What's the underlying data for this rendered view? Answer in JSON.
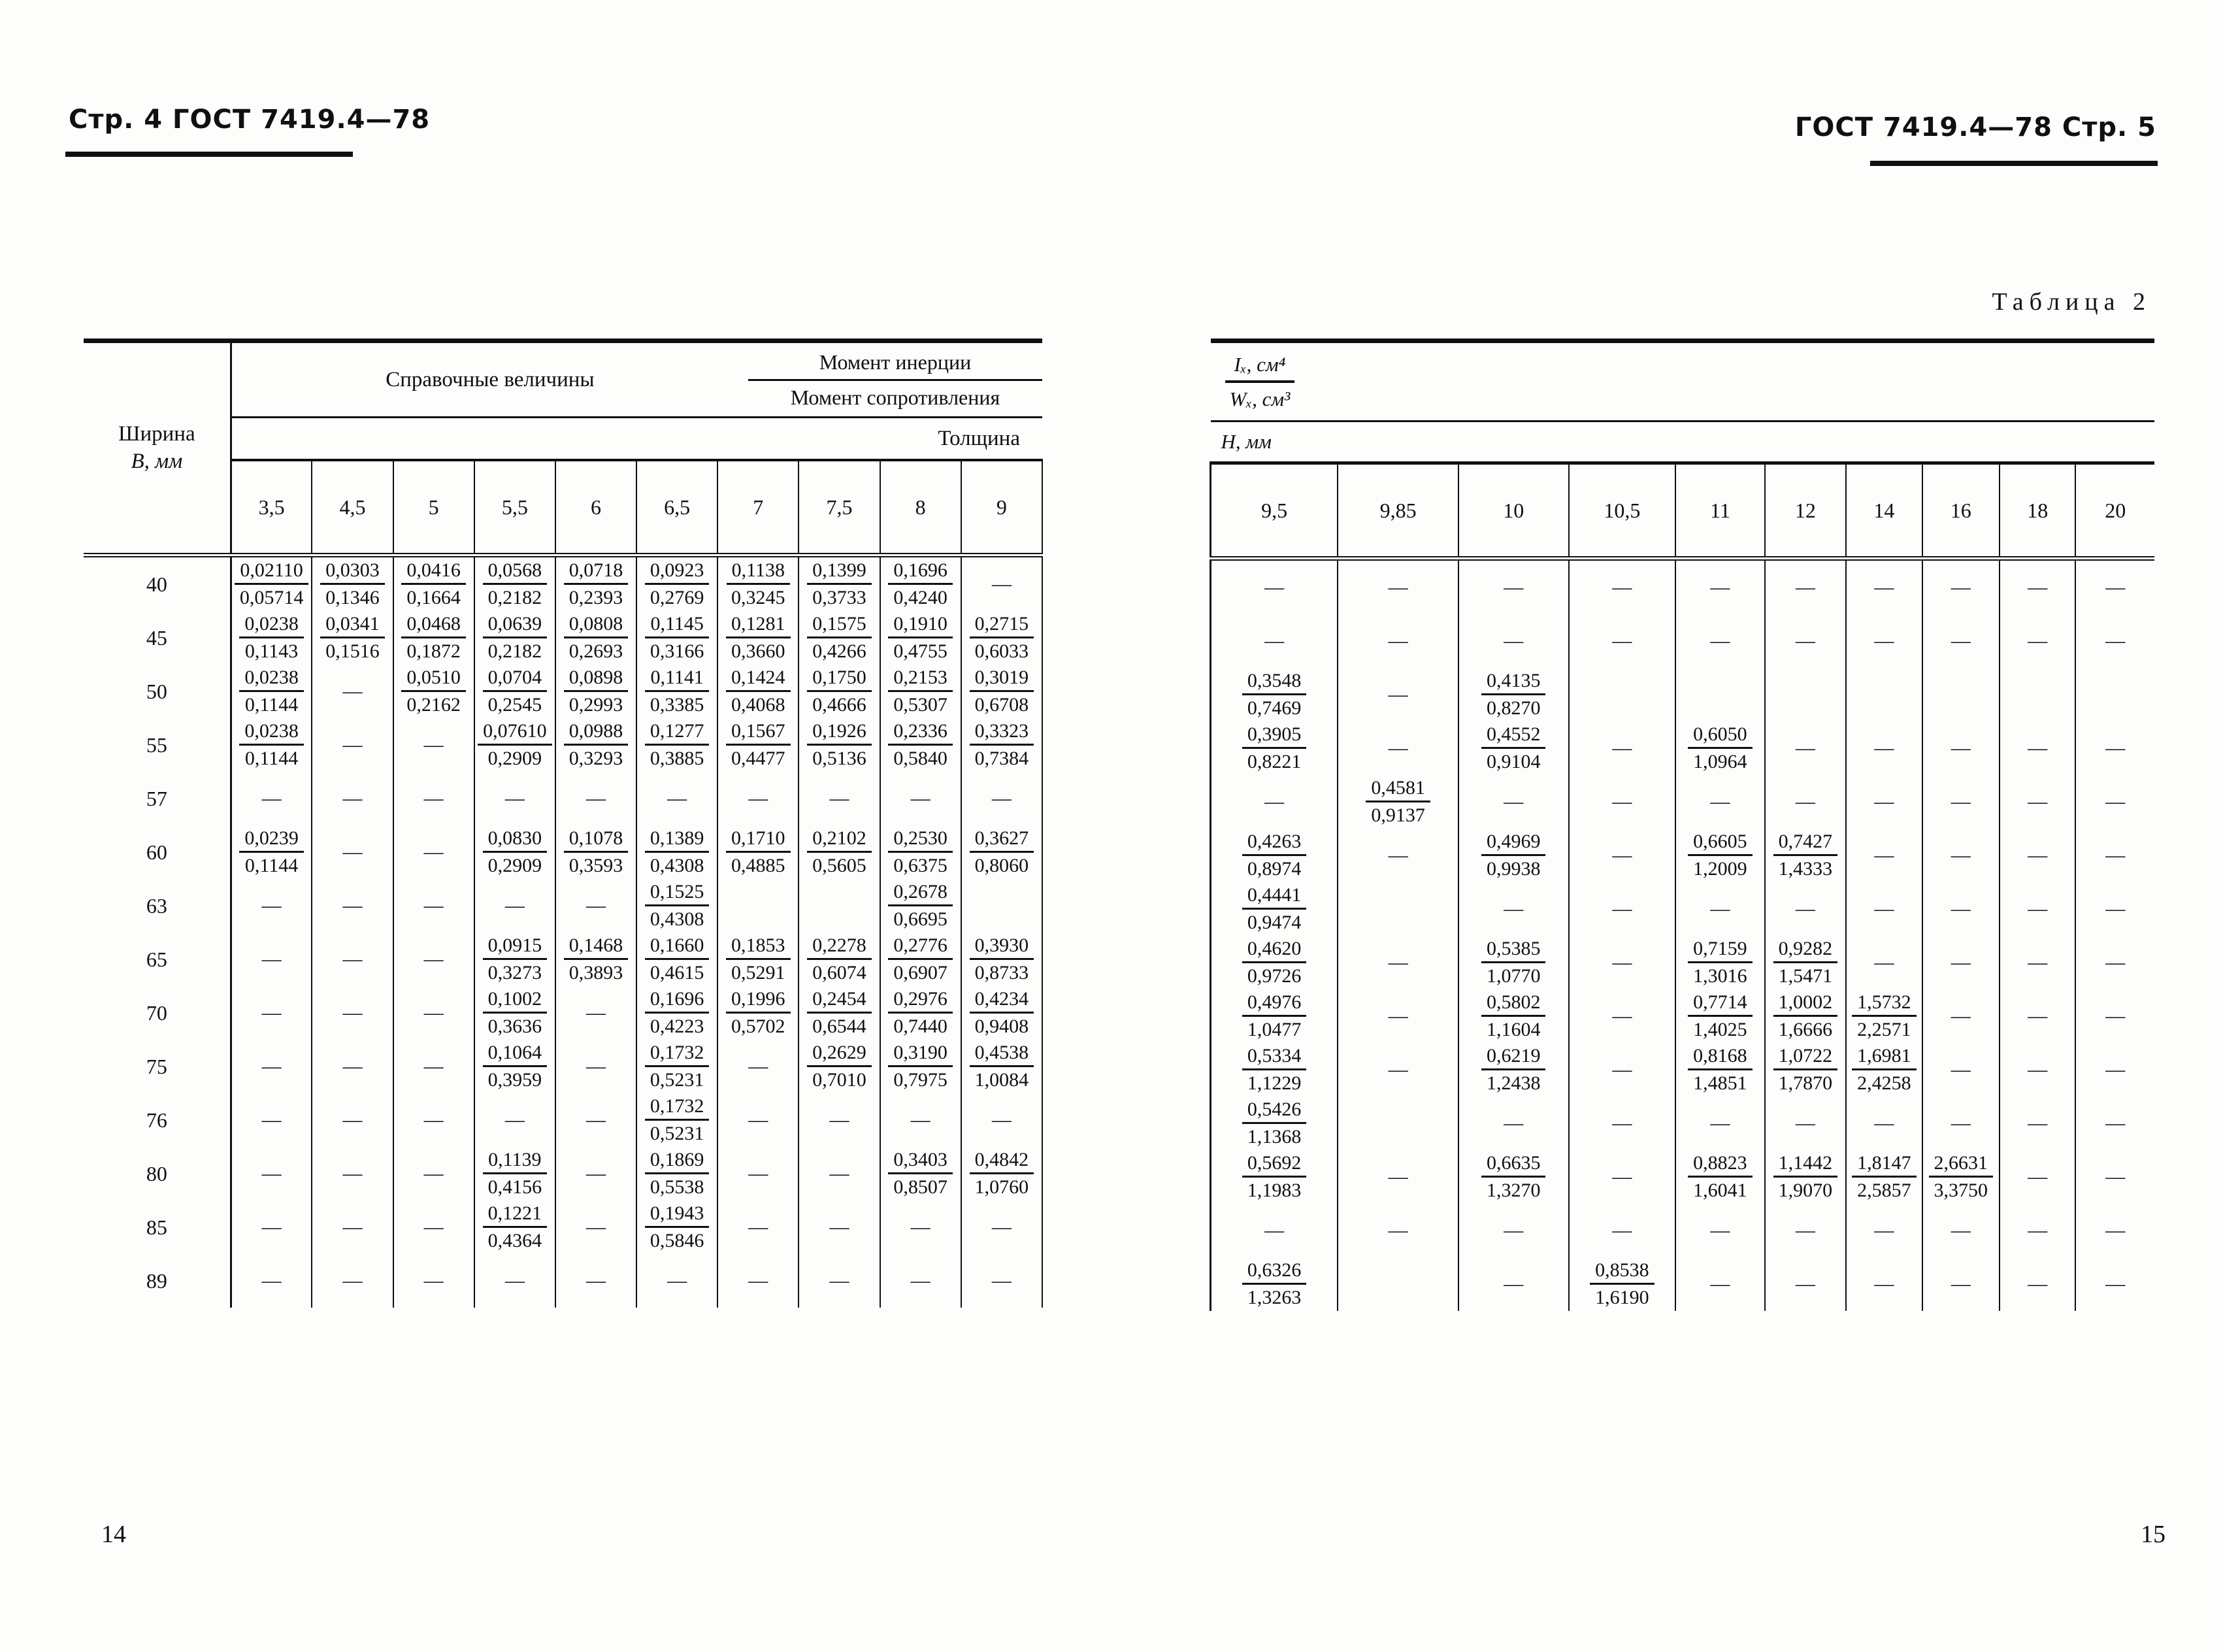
{
  "left_page": {
    "header": "Стр. 4 ГОСТ 7419.4—78",
    "folio": "14",
    "table": {
      "width_label": "Ширина",
      "width_unit": "В, мм",
      "ref_label": "Справочные величины",
      "moment_inertia": "Момент инерции",
      "moment_resistance": "Момент сопротивления",
      "thickness_label": "Толщина",
      "columns": [
        "3,5",
        "4,5",
        "5",
        "5,5",
        "6",
        "6,5",
        "7",
        "7,5",
        "8",
        "9"
      ],
      "row_labels": [
        "40",
        "45",
        "50",
        "55",
        "57",
        "60",
        "63",
        "65",
        "70",
        "75",
        "76",
        "80",
        "85",
        "89"
      ],
      "rows": [
        [
          "0,02110/0,05714",
          "0,0303/0,1346",
          "0,0416/0,1664",
          "0,0568/0,2182",
          "0,0718/0,2393",
          "0,0923/0,2769",
          "0,1138/0,3245",
          "0,1399/0,3733",
          "0,1696/0,4240",
          "—"
        ],
        [
          "0,0238/0,1143",
          "0,0341/0,1516",
          "0,0468/0,1872",
          "0,0639/0,2182",
          "0,0808/0,2693",
          "0,1145/0,3166",
          "0,1281/0,3660",
          "0,1575/0,4266",
          "0,1910/0,4755",
          "0,2715/0,6033"
        ],
        [
          "0,0238/0,1144",
          "—",
          "0,0510/0,2162",
          "0,0704/0,2545",
          "0,0898/0,2993",
          "0,1141/0,3385",
          "0,1424/0,4068",
          "0,1750/0,4666",
          "0,2153/0,5307",
          "0,3019/0,6708"
        ],
        [
          "0,0238/0,1144",
          "—",
          "—",
          "0,07610/0,2909",
          "0,0988/0,3293",
          "0,1277/0,3885",
          "0,1567/0,4477",
          "0,1926/0,5136",
          "0,2336/0,5840",
          "0,3323/0,7384"
        ],
        [
          "—",
          "—",
          "—",
          "—",
          "—",
          "—",
          "—",
          "—",
          "—",
          "—"
        ],
        [
          "0,0239/0,1144",
          "—",
          "—",
          "0,0830/0,2909",
          "0,1078/0,3593",
          "0,1389/0,4308",
          "0,1710/0,4885",
          "0,2102/0,5605",
          "0,2530/0,6375",
          "0,3627/0,8060"
        ],
        [
          "—",
          "—",
          "—",
          "—",
          "—",
          "0,1525/0,4308",
          "",
          "",
          "0,2678/0,6695",
          ""
        ],
        [
          "—",
          "—",
          "—",
          "0,0915/0,3273",
          "0,1468/0,3893",
          "0,1660/0,4615",
          "0,1853/0,5291",
          "0,2278/0,6074",
          "0,2776/0,6907",
          "0,3930/0,8733"
        ],
        [
          "—",
          "—",
          "—",
          "0,1002/0,3636",
          "—",
          "0,1696/0,4223",
          "0,1996/0,5702",
          "0,2454/0,6544",
          "0,2976/0,7440",
          "0,4234/0,9408"
        ],
        [
          "—",
          "—",
          "—",
          "0,1064/0,3959",
          "—",
          "0,1732/0,5231",
          "—",
          "0,2629/0,7010",
          "0,3190/0,7975",
          "0,4538/1,0084"
        ],
        [
          "—",
          "—",
          "—",
          "—",
          "—",
          "0,1732/0,5231",
          "—",
          "—",
          "—",
          "—"
        ],
        [
          "—",
          "—",
          "—",
          "0,1139/0,4156",
          "—",
          "0,1869/0,5538",
          "—",
          "—",
          "0,3403/0,8507",
          "0,4842/1,0760"
        ],
        [
          "—",
          "—",
          "—",
          "0,1221/0,4364",
          "—",
          "0,1943/0,5846",
          "—",
          "—",
          "—",
          "—"
        ],
        [
          "—",
          "—",
          "—",
          "—",
          "—",
          "—",
          "—",
          "—",
          "—",
          "—"
        ]
      ]
    }
  },
  "right_page": {
    "header": "ГОСТ 7419.4—78 Стр. 5",
    "table_caption": "Таблица 2",
    "folio": "15",
    "table": {
      "ix_label": "Iₓ, см⁴",
      "wx_label": "Wₓ, см³",
      "h_label": "Н, мм",
      "columns": [
        "9,5",
        "9,85",
        "10",
        "10,5",
        "11",
        "12",
        "14",
        "16",
        "18",
        "20"
      ],
      "rows": [
        [
          "—",
          "—",
          "—",
          "—",
          "—",
          "—",
          "—",
          "—",
          "—",
          "—"
        ],
        [
          "—",
          "—",
          "—",
          "—",
          "—",
          "—",
          "—",
          "—",
          "—",
          "—"
        ],
        [
          "0,3548/0,7469",
          "—",
          "0,4135/0,8270",
          "",
          "",
          "",
          "",
          "",
          "",
          ""
        ],
        [
          "0,3905/0,8221",
          "—",
          "0,4552/0,9104",
          "—",
          "0,6050/1,0964",
          "—",
          "—",
          "—",
          "—",
          "—"
        ],
        [
          "—",
          "0,4581/0,9137",
          "—",
          "—",
          "—",
          "—",
          "—",
          "—",
          "—",
          "—"
        ],
        [
          "0,4263/0,8974",
          "—",
          "0,4969/0,9938",
          "—",
          "0,6605/1,2009",
          "0,7427/1,4333",
          "—",
          "—",
          "—",
          "—"
        ],
        [
          "0,4441/0,9474",
          "",
          "—",
          "—",
          "—",
          "—",
          "—",
          "—",
          "—",
          "—"
        ],
        [
          "0,4620/0,9726",
          "—",
          "0,5385/1,0770",
          "—",
          "0,7159/1,3016",
          "0,9282/1,5471",
          "—",
          "—",
          "—",
          "—"
        ],
        [
          "0,4976/1,0477",
          "—",
          "0,5802/1,1604",
          "—",
          "0,7714/1,4025",
          "1,0002/1,6666",
          "1,5732/2,2571",
          "—",
          "—",
          "—"
        ],
        [
          "0,5334/1,1229",
          "—",
          "0,6219/1,2438",
          "—",
          "0,8168/1,4851",
          "1,0722/1,7870",
          "1,6981/2,4258",
          "—",
          "—",
          "—"
        ],
        [
          "0,5426/1,1368",
          "",
          "—",
          "—",
          "—",
          "—",
          "—",
          "—",
          "—",
          "—"
        ],
        [
          "0,5692/1,1983",
          "—",
          "0,6635/1,3270",
          "—",
          "0,8823/1,6041",
          "1,1442/1,9070",
          "1,8147/2,5857",
          "2,6631/3,3750",
          "—",
          "—"
        ],
        [
          "—",
          "—",
          "—",
          "—",
          "—",
          "—",
          "—",
          "—",
          "—",
          "—"
        ],
        [
          "0,6326/1,3263",
          "",
          "—",
          "0,8538/1,6190",
          "—",
          "—",
          "—",
          "—",
          "—",
          "—"
        ]
      ]
    }
  }
}
